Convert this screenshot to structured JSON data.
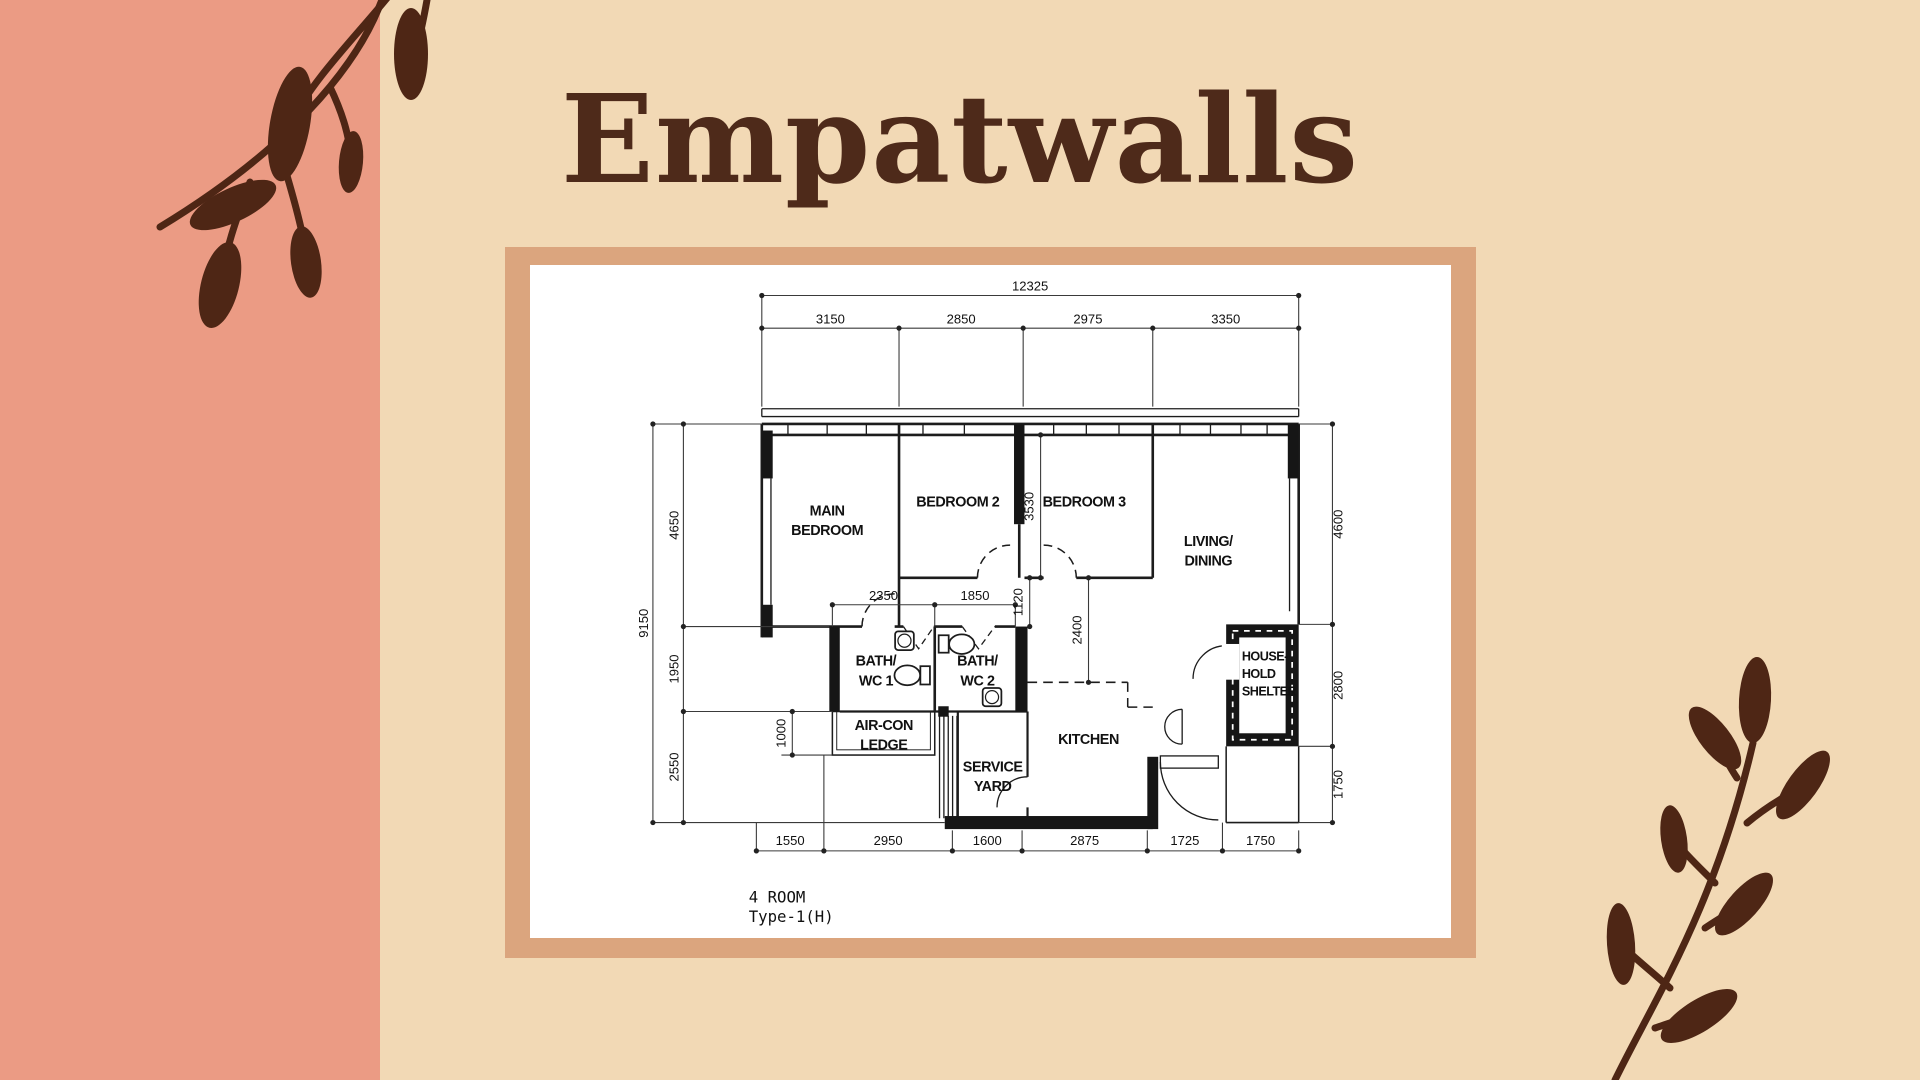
{
  "page": {
    "title": "Empatwalls"
  },
  "colors": {
    "left_stripe": "#EB9B84",
    "background": "#F2D9B5",
    "frame": "#DBA57E",
    "card": "#FFFFFF",
    "title_text": "#4E2A1A",
    "branch": "#4E2615",
    "plan_line": "#1C1C1C"
  },
  "plan": {
    "footer": {
      "line1": "4 ROOM",
      "line2": "Type-1(H)"
    },
    "dims": {
      "top_total": "12325",
      "top_segments": [
        "3150",
        "2850",
        "2975",
        "3350"
      ],
      "left_total": "9150",
      "left_segments": [
        "4650",
        "1950",
        "2550"
      ],
      "right_segments": [
        "4600",
        "2800",
        "1750"
      ],
      "bottom_segments": [
        "1550",
        "2950",
        "1600",
        "2875",
        "1725",
        "1750"
      ],
      "bath1_width": "2350",
      "bath2_width": "1850",
      "corridor": "1120",
      "bedroom3_depth": "3530",
      "kitchen_offset": "2400",
      "ledge_depth": "1000"
    },
    "rooms": {
      "main_bedroom": {
        "line1": "MAIN",
        "line2": "BEDROOM"
      },
      "bedroom2": "BEDROOM 2",
      "bedroom3": "BEDROOM 3",
      "living": {
        "line1": "LIVING/",
        "line2": "DINING"
      },
      "bath1": {
        "line1": "BATH/",
        "line2": "WC 1"
      },
      "bath2": {
        "line1": "BATH/",
        "line2": "WC 2"
      },
      "aircon": {
        "line1": "AIR-CON",
        "line2": "LEDGE"
      },
      "service": {
        "line1": "SERVICE",
        "line2": "YARD"
      },
      "kitchen": "KITCHEN",
      "shelter": {
        "line1": "HOUSE-",
        "line2": "HOLD",
        "line3": "SHELTER"
      }
    }
  }
}
